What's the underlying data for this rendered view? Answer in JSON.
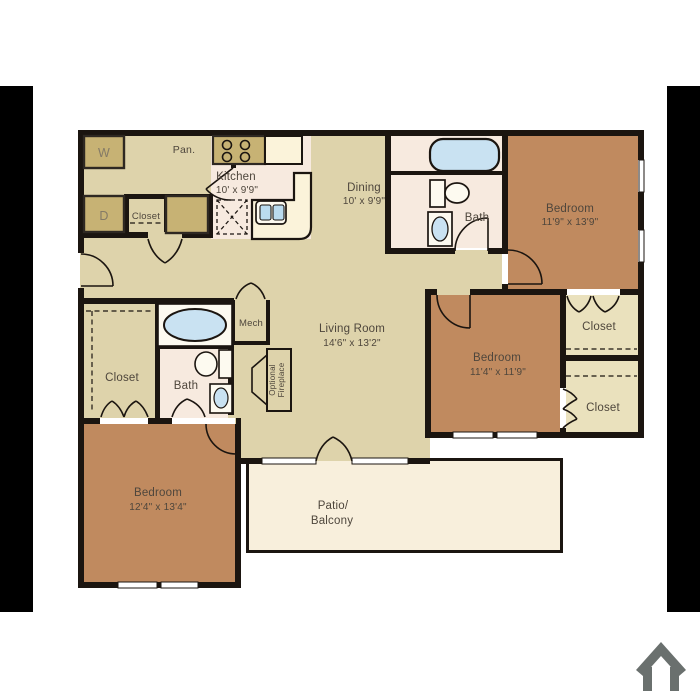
{
  "page": {
    "background": "#ffffff",
    "type": "apartment-floor-plan"
  },
  "decor": {
    "left_bar_color": "#000000",
    "right_bar_color": "#000000"
  },
  "branding": {
    "house_icon": "house-outline-logo",
    "icon_color": "#6a706e"
  },
  "colors": {
    "floor_tan": "#ded3ab",
    "bedroom_brown": "#c08a5f",
    "appliance_gold": "#c7b274",
    "counter_cream": "#fbf3da",
    "kitchen_bath_floor": "#f7eadf",
    "patio_cream": "#f8efdc",
    "closet_light": "#eae1bd",
    "wall": "#1b1510",
    "text": "#4e463c",
    "fixture_blue": "#c9e2f2",
    "sink_blue": "#badbee"
  },
  "floorplan": {
    "rooms": {
      "kitchen": {
        "name": "Kitchen",
        "dims": "10' x 9'9\""
      },
      "dining": {
        "name": "Dining",
        "dims": "10' x 9'9\""
      },
      "living_room": {
        "name": "Living Room",
        "dims": "14'6\" x 13'2\""
      },
      "bedroom_top_right": {
        "name": "Bedroom",
        "dims": "11'9\" x 13'9\""
      },
      "bedroom_mid_right": {
        "name": "Bedroom",
        "dims": "11'4\" x 11'9\""
      },
      "bedroom_bottom_left": {
        "name": "Bedroom",
        "dims": "12'4\" x 13'4\""
      },
      "patio": {
        "line1": "Patio/",
        "line2": "Balcony"
      },
      "bath_top": {
        "name": "Bath"
      },
      "bath_left": {
        "name": "Bath"
      },
      "mech": {
        "name": "Mech"
      },
      "pantry": {
        "name": "Pan."
      },
      "washer": {
        "name": "W"
      },
      "dryer": {
        "name": "D"
      },
      "closet_laundry": {
        "name": "Closet"
      },
      "closet_walkin": {
        "name": "Closet"
      },
      "closet_upper_right": {
        "name": "Closet"
      },
      "closet_lower_right": {
        "name": "Closet"
      },
      "fireplace": {
        "line1": "Optional",
        "line2": "Fireplace"
      }
    }
  }
}
